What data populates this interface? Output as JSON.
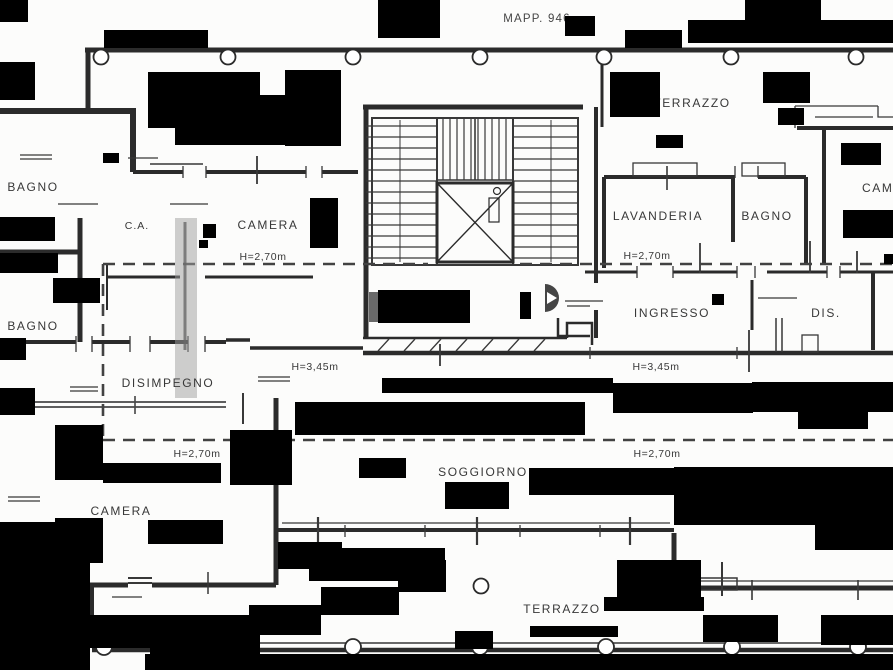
{
  "document": {
    "map_label": "MAPP. 946"
  },
  "floor_plan": {
    "rooms": {
      "terrazzo_top": "TERRAZZO",
      "bagno_upper_left": "BAGNO",
      "ca": "C.A.",
      "camera_upper": "CAMERA",
      "lavanderia": "LAVANDERIA",
      "bagno_right": "BAGNO",
      "camera_right": "CAMERA",
      "bagno_lower_left": "BAGNO",
      "ingresso": "INGRESSO",
      "dis": "DIS.",
      "disimpegno": "DISIMPEGNO",
      "camera_lower_left": "CAMERA",
      "soggiorno": "SOGGIORNO",
      "terrazzo_bottom": "TERRAZZO"
    },
    "heights": {
      "upper_left": "H=2,70m",
      "upper_right": "H=2,70m",
      "mid_left": "H=3,45m",
      "mid_right": "H=3,45m",
      "lower_left": "H=2,70m",
      "lower_right": "H=2,70m"
    },
    "colors": {
      "line": "#2d2d2d",
      "background": "#fcfcfb",
      "artifact_black": "#000000",
      "smudge_gray": "#9e9e9e",
      "dashed_line": "#444444"
    }
  }
}
